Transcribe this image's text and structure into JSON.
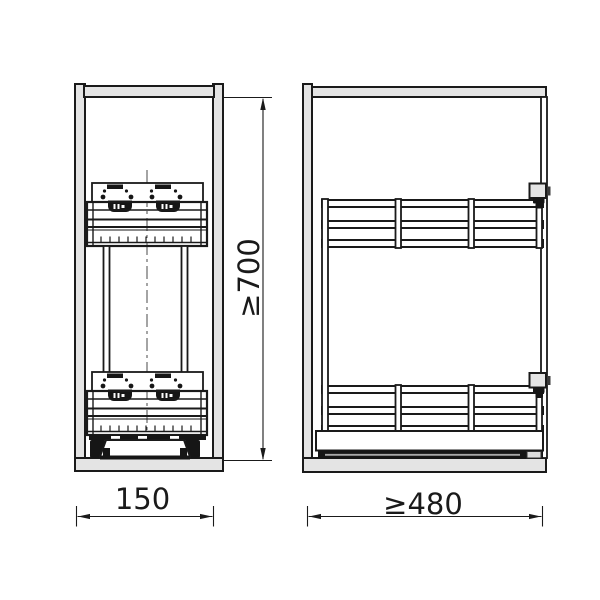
{
  "drawing": {
    "subject": "pull-out-basket-cabinet-technical-drawing",
    "views": [
      {
        "id": "front",
        "name": "front view"
      },
      {
        "id": "side",
        "name": "side view"
      }
    ],
    "dimensions": {
      "cabinet_height": {
        "text": "≥700",
        "orientation": "vertical"
      },
      "cabinet_width": {
        "text": "150",
        "orientation": "horizontal"
      },
      "cabinet_depth": {
        "text": "≥480",
        "orientation": "horizontal"
      }
    },
    "colors": {
      "panel_fill": "#e4e4e4",
      "line": "#1a1a1a",
      "background": "#ffffff"
    }
  }
}
